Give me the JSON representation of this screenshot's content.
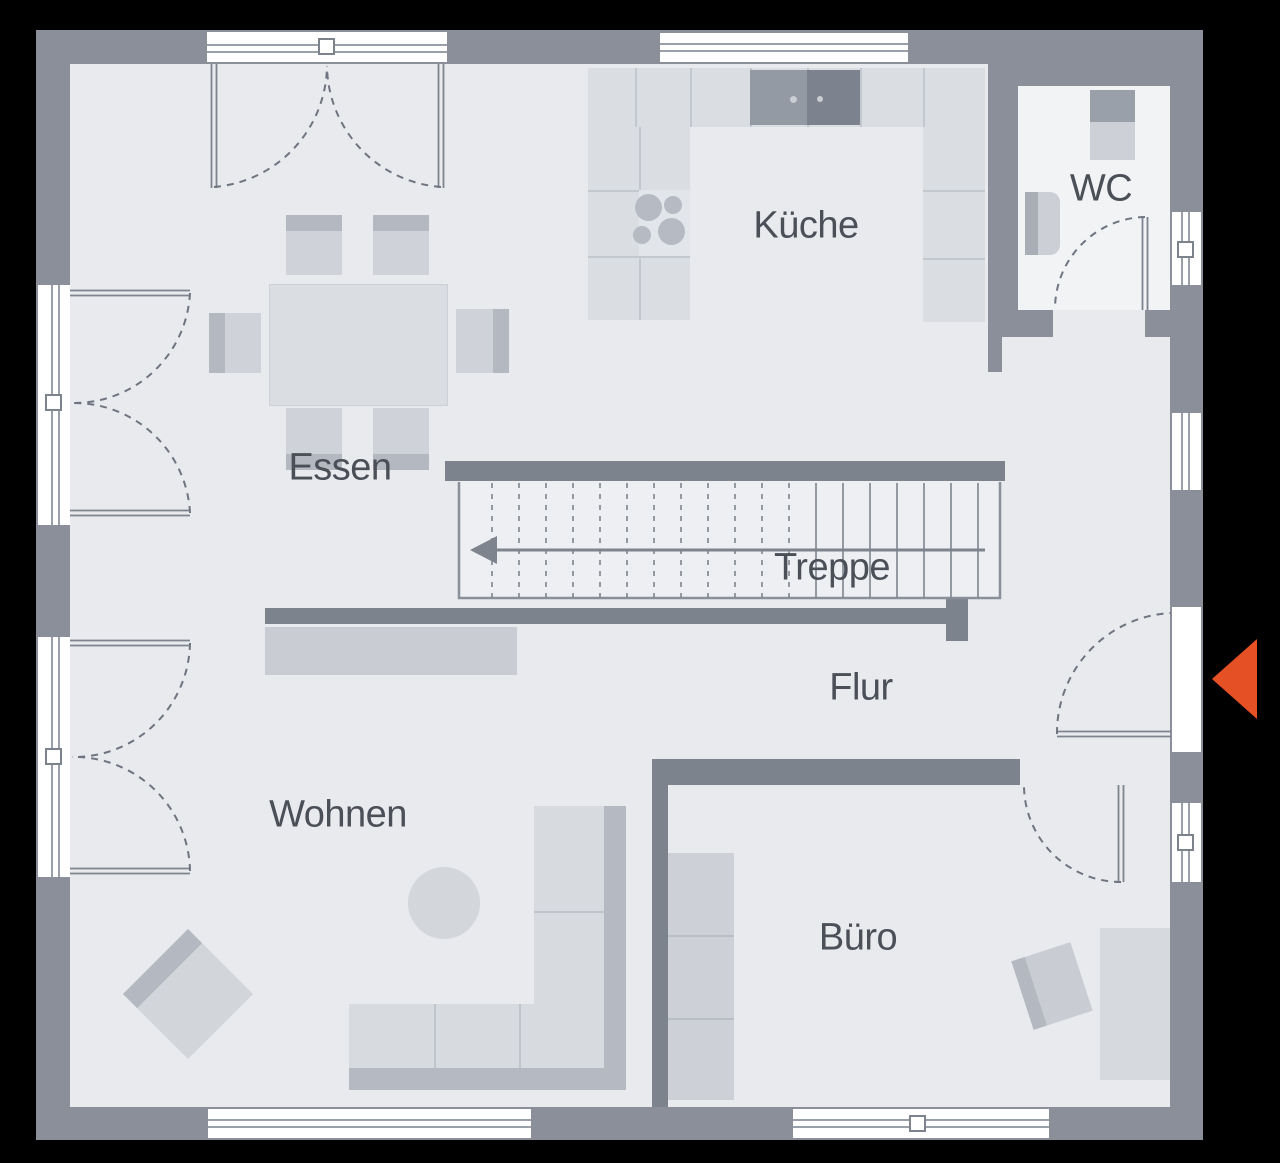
{
  "rooms": {
    "kueche": {
      "label": "Küche"
    },
    "wc": {
      "label": "WC"
    },
    "essen": {
      "label": "Essen"
    },
    "treppe": {
      "label": "Treppe"
    },
    "flur": {
      "label": "Flur"
    },
    "wohnen": {
      "label": "Wohnen"
    },
    "buero": {
      "label": "Büro"
    }
  },
  "stairs": {
    "direction_arrow": "left"
  },
  "entrance": {
    "marker": "entrance-arrow",
    "pointing": "left"
  },
  "colors": {
    "background": "#000000",
    "outer_wall": "#8a8f99",
    "inner_wall": "#7d838d",
    "floor": "#e8eaee",
    "wc_floor": "#f1f3f5",
    "counter": "#dadde2",
    "furniture": "#d6d9de",
    "furniture_accent": "#b4b8c0",
    "appliance_mid": "#949aa4",
    "appliance_dark": "#7d838e",
    "window_line": "#9aa0a9",
    "label_text": "#4b4f57",
    "entrance_arrow": "#e55124"
  }
}
